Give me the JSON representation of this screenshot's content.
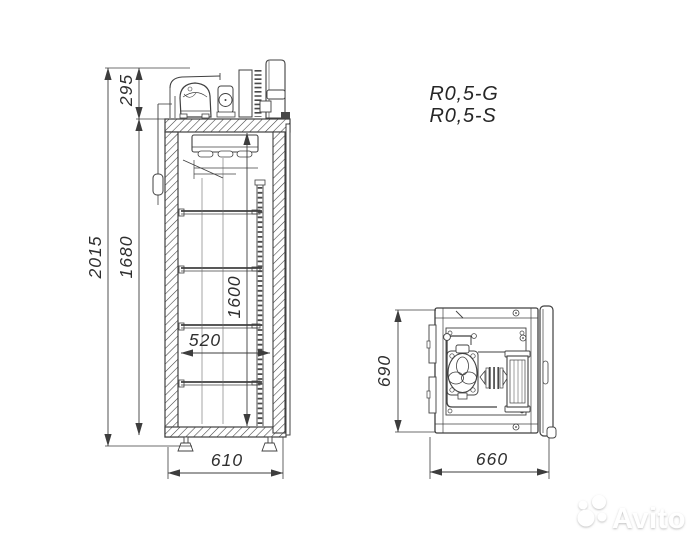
{
  "document": {
    "type": "technical-drawing",
    "background": "#ffffff",
    "line_color": "#404040",
    "text_color": "#2f2f2f"
  },
  "models": {
    "line1": "R0,5-G",
    "line2": "R0,5-S"
  },
  "side_view": {
    "description": "side cross-section of refrigerated cabinet with top compressor unit, evaporator, four shelves and adjustable feet",
    "dimensions": {
      "overall_height": "2015",
      "body_height": "1680",
      "machine_compartment_height": "295",
      "internal_height": "1600",
      "internal_width": "520",
      "overall_width": "610"
    }
  },
  "top_view": {
    "description": "plan view of machine compartment with compressor, fan motor and condenser",
    "dimensions": {
      "overall_depth": "690",
      "overall_width": "660"
    }
  },
  "watermark": {
    "brand": "Avito",
    "logo": "avito-circles-logo",
    "color": "#ffffff"
  }
}
